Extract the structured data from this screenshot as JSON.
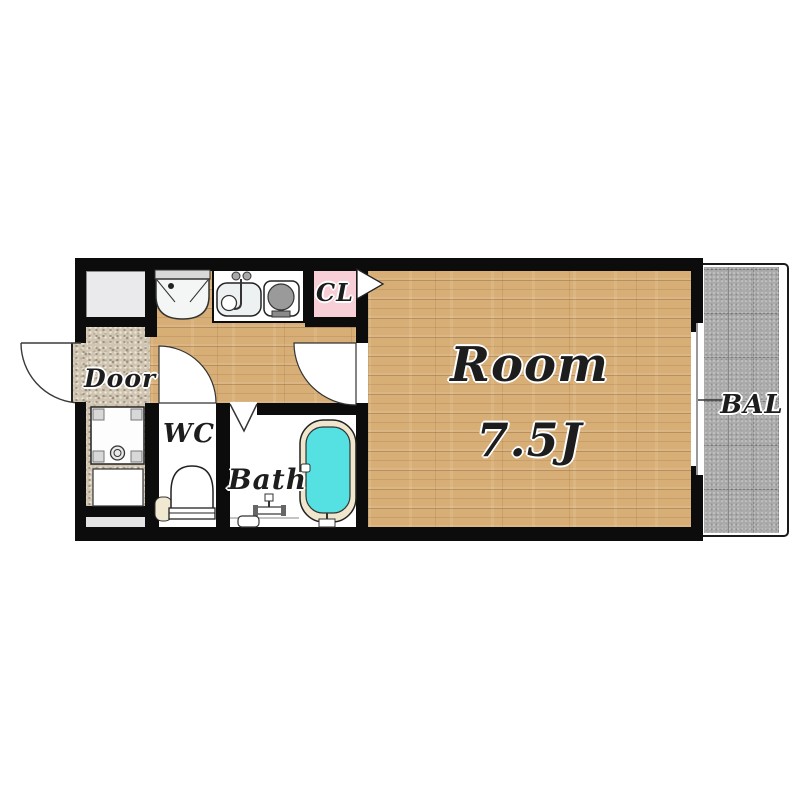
{
  "floorplan": {
    "rooms": {
      "room": {
        "label": "Room",
        "size": "7.5J"
      },
      "balcony": {
        "label": "BAL"
      },
      "entrance": {
        "label": "Door"
      },
      "wc": {
        "label": "WC"
      },
      "bath": {
        "label": "Bath"
      },
      "closet": {
        "label": "CL"
      }
    },
    "colors": {
      "wall": "#0c0c0c",
      "wood_floor": "#d7ae76",
      "entrance_stone": "#d0c5b2",
      "closet_pink": "#f9cfd7",
      "bathtub_cyan": "#55e1e1",
      "tub_rim_cream": "#efe6cd",
      "balcony_gray": "#ababab",
      "storage_gray": "#eaeaec"
    },
    "icons": [
      "washing-machine-icon",
      "kitchen-sink-icon",
      "faucet-icon",
      "stove-burner-icon",
      "washer-pan-icon",
      "shoe-box-icon",
      "toilet-icon",
      "bathtub-icon",
      "shower-faucet-icon",
      "bath-stool-icon",
      "folding-door-icon",
      "entrance-door-swing-icon",
      "wc-door-swing-icon",
      "room-door-swing-icon",
      "closet-door-triangle-icon",
      "window-icon",
      "balcony-tick-icon"
    ]
  }
}
